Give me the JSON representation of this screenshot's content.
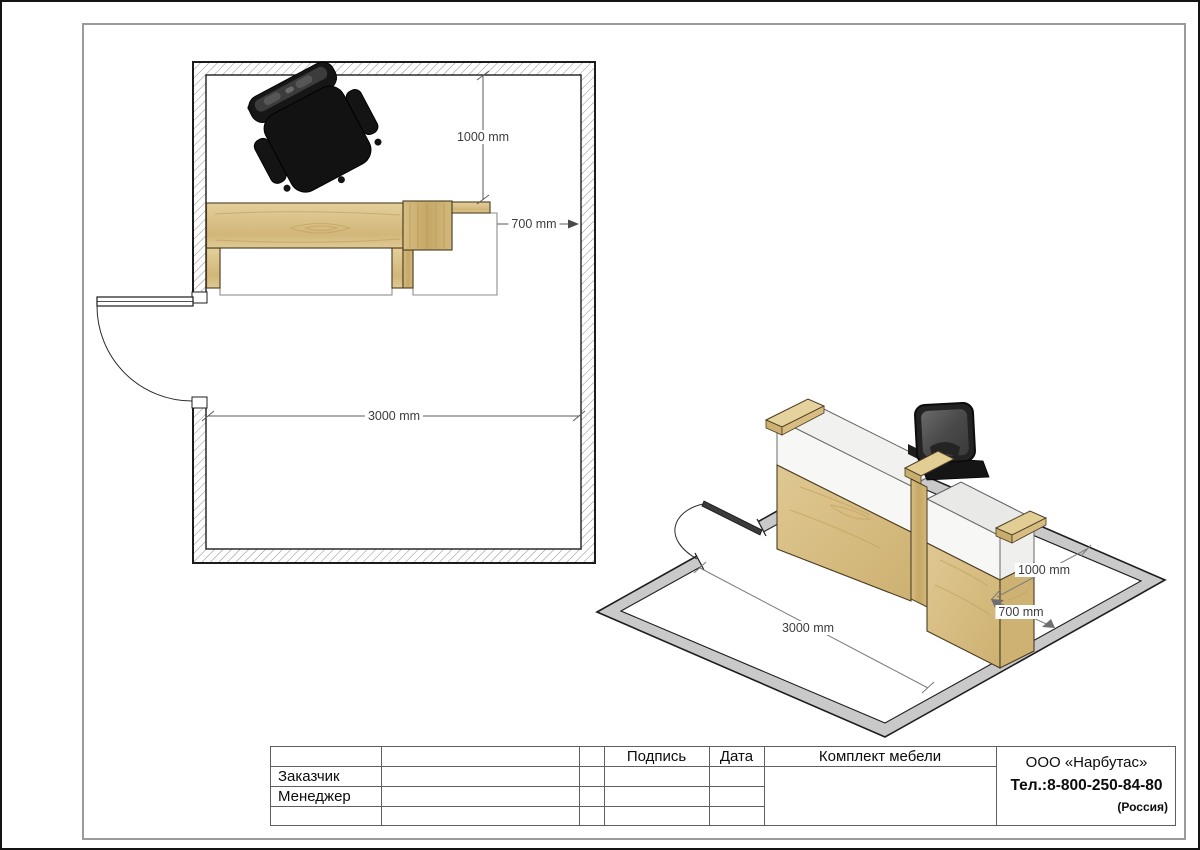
{
  "sheet": {
    "title_block": {
      "customer_label": "Заказчик",
      "manager_label": "Менеджер",
      "signature_header": "Подпись",
      "date_header": "Дата",
      "furniture_set_header": "Комплект мебели",
      "customer_value": "",
      "manager_value": ""
    },
    "company": {
      "name": "ООО «Нарбутас»",
      "phone": "Тел.:8-800-250-84-80",
      "country": "(Россия)"
    }
  },
  "plan": {
    "dims": {
      "back_clearance": "1000 mm",
      "side_clearance": "700 mm",
      "room_width": "3000 mm"
    }
  },
  "iso": {
    "dims": {
      "room_width": "3000 mm",
      "depth_clearance": "1000 mm",
      "side_clearance": "700 mm"
    }
  },
  "colors": {
    "wood_light": "#ddc78e",
    "wood_mid": "#d3b97c",
    "wood_dark_block": "#cbb06e",
    "floor_band_gray": "#c9c9c9",
    "chair_black": "#1d1d1d",
    "panel_white": "#f6f6f4",
    "line_gray": "#5f5f5f"
  }
}
